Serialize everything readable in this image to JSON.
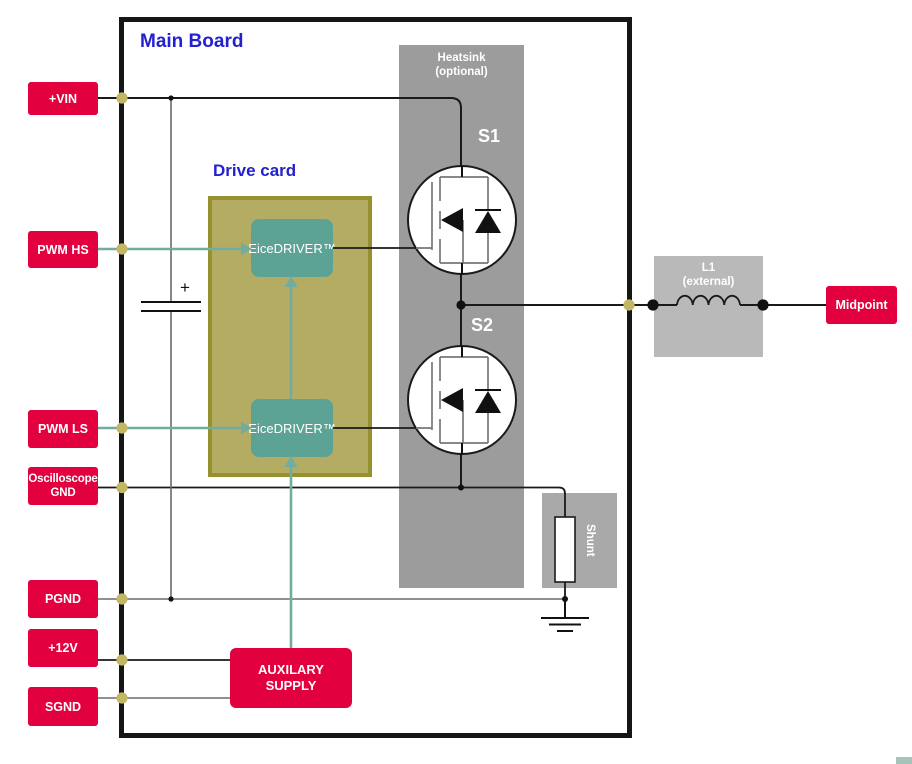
{
  "board": {
    "title": "Main Board"
  },
  "drive_card": {
    "title": "Drive card",
    "driver_hs": "EiceDRIVER™",
    "driver_ls": "EiceDRIVER™"
  },
  "ports": {
    "vin": "+VIN",
    "pwm_hs": "PWM HS",
    "pwm_ls": "PWM LS",
    "osc_gnd": "Oscilloscope GND",
    "pgnd": "PGND",
    "v12": "+12V",
    "sgnd": "SGND",
    "midpoint": "Midpoint"
  },
  "components": {
    "heatsink": {
      "line1": "Heatsink",
      "line2": "(optional)"
    },
    "switch_hs": "S1",
    "switch_ls": "S2",
    "inductor": {
      "line1": "L1",
      "line2": "(external)"
    },
    "shunt": "Shunt",
    "aux_supply": {
      "line1": "AUXILARY",
      "line2": "SUPPLY"
    },
    "capacitor_polarity": "+"
  },
  "colors": {
    "red": "#E2003E",
    "teal_box": "#5CA396",
    "teal_wire": "#72AC9F",
    "olive_fill": "#B4AC63",
    "olive_border": "#97902F",
    "heatsink_gray": "#9C9C9C",
    "shunt_gray": "#A9A9A9",
    "inductor_gray": "#B9B9B9",
    "label_blue": "#2321CE",
    "dot_khaki": "#C2B765",
    "corner_teal": "#A5C3B8"
  }
}
